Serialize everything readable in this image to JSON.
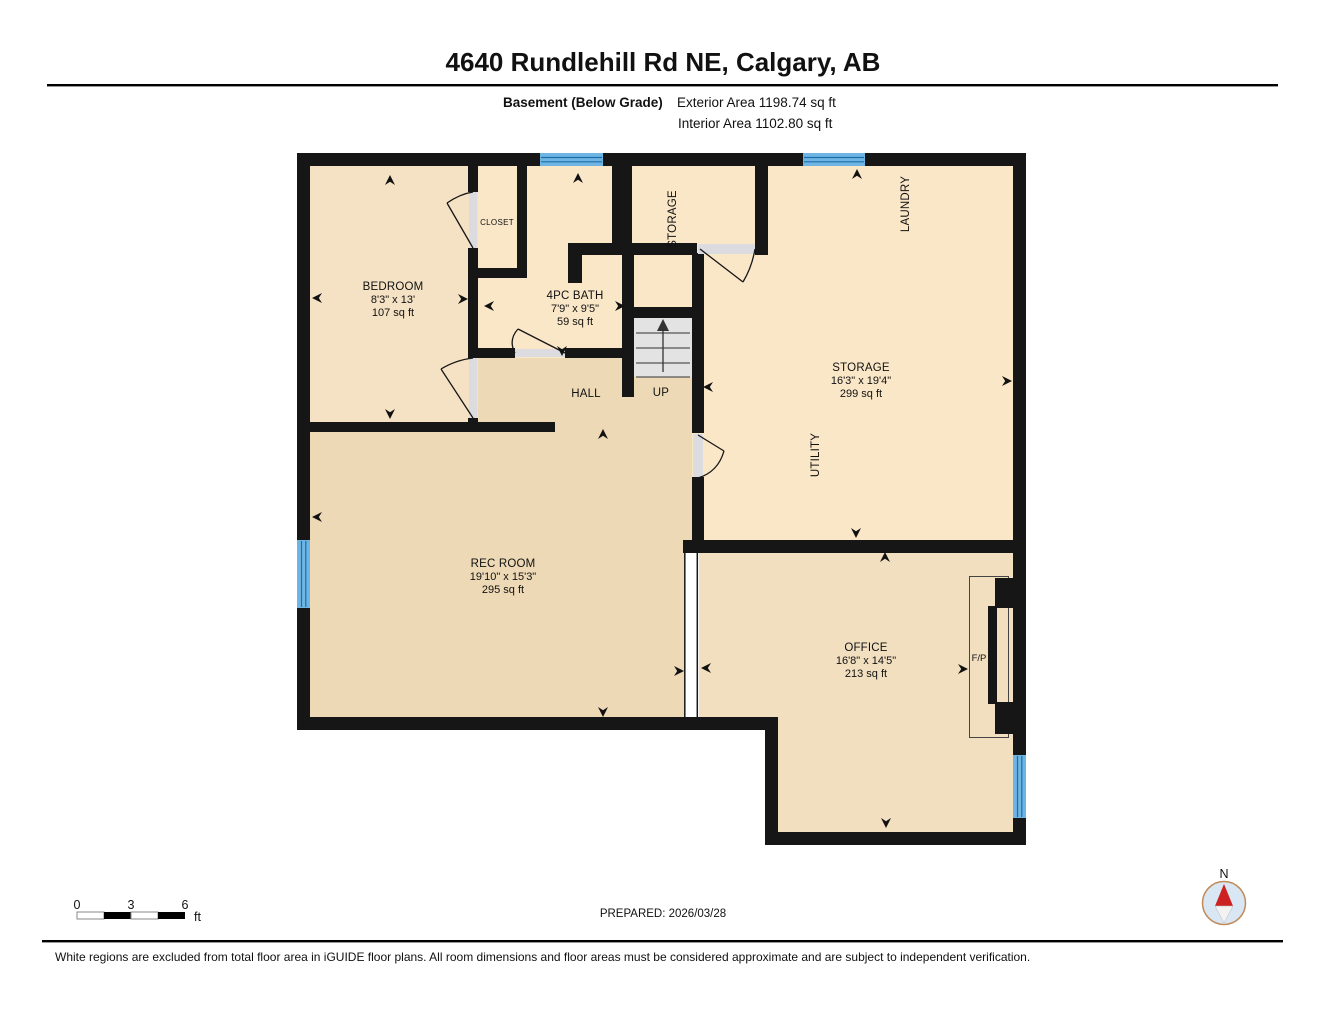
{
  "header": {
    "title": "4640 Rundlehill Rd NE, Calgary, AB",
    "floor_label": "Basement (Below Grade)",
    "exterior_area": "Exterior Area 1198.74 sq ft",
    "interior_area": "Interior Area 1102.80 sq ft"
  },
  "rooms": {
    "bedroom": {
      "name": "BEDROOM",
      "dims": "8'3\" x 13'",
      "area": "107 sq ft"
    },
    "bath": {
      "name": "4PC BATH",
      "dims": "7'9\" x 9'5\"",
      "area": "59 sq ft"
    },
    "storage": {
      "name": "STORAGE",
      "dims": "16'3\" x 19'4\"",
      "area": "299 sq ft"
    },
    "rec_room": {
      "name": "REC ROOM",
      "dims": "19'10\" x 15'3\"",
      "area": "295 sq ft"
    },
    "office": {
      "name": "OFFICE",
      "dims": "16'8\" x 14'5\"",
      "area": "213 sq ft"
    },
    "closet": {
      "name": "CLOSET"
    },
    "hall": {
      "name": "HALL"
    },
    "storage_small": {
      "name": "STORAGE"
    },
    "laundry": {
      "name": "LAUNDRY"
    },
    "utility": {
      "name": "UTILITY"
    }
  },
  "annotations": {
    "stairs_up": "UP",
    "fireplace": "F/P"
  },
  "scale_bar": {
    "tick_0": "0",
    "tick_3": "3",
    "tick_6": "6",
    "unit": "ft"
  },
  "prepared": "PREPARED: 2026/03/28",
  "compass": {
    "north_label": "N"
  },
  "disclaimer": "White regions are excluded from total floor area in iGUIDE floor plans. All room dimensions and floor areas must be considered approximate and are subject to independent verification.",
  "colors": {
    "wall": "#161616",
    "window_blue": "#6FB5E4",
    "window_line": "#1D6EA8",
    "floor_peach": "#FAE7C8",
    "floor_bedroom": "#F5E2C4",
    "floor_tan": "#EDD9B5",
    "floor_office": "#F1DFC0",
    "door_gray": "#DCDCE0",
    "stair_gray": "#E3E3E3",
    "compass_red": "#CC2222",
    "compass_ring": "#C18A58",
    "compass_fill": "#D8E7F3"
  }
}
